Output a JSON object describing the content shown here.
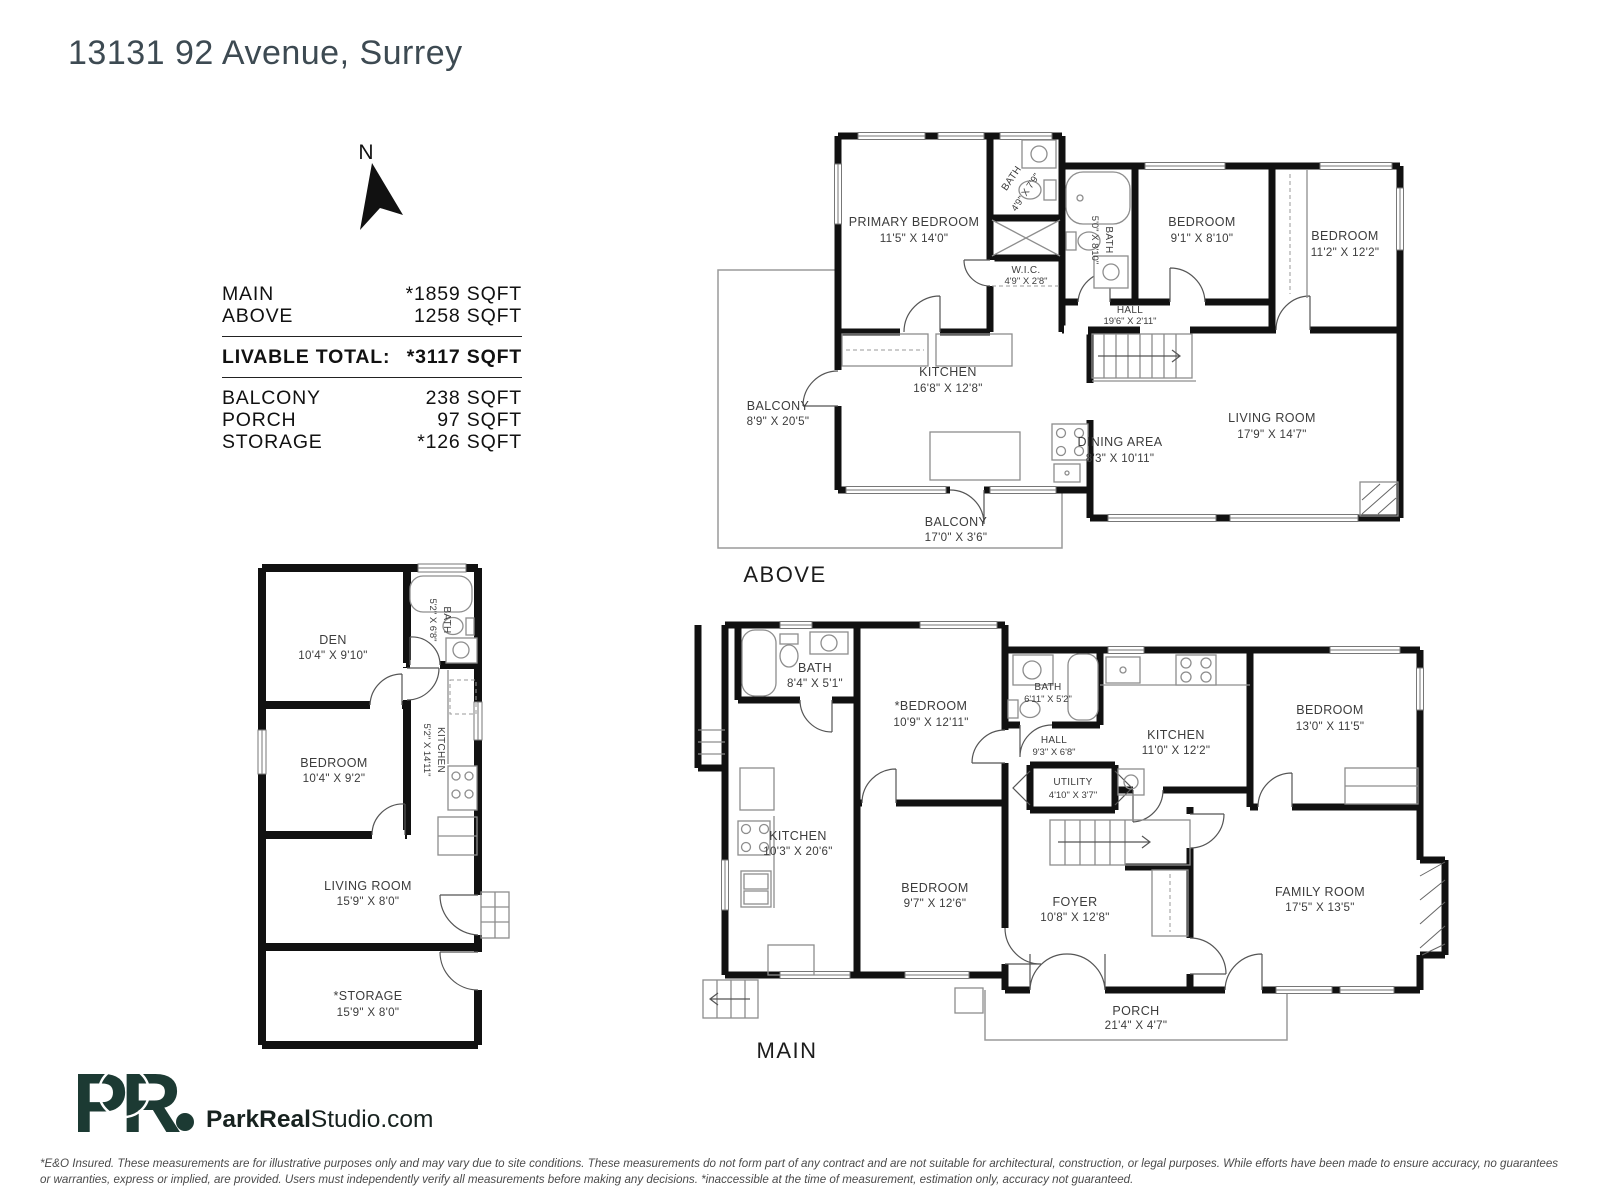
{
  "title": "13131 92 Avenue, Surrey",
  "compass": {
    "label": "N"
  },
  "area_summary": {
    "rows": [
      {
        "label": "MAIN",
        "value": "*1859 SQFT"
      },
      {
        "label": "ABOVE",
        "value": "1258 SQFT"
      }
    ],
    "total": {
      "label": "LIVABLE TOTAL:",
      "value": "*3117 SQFT"
    },
    "extras": [
      {
        "label": "BALCONY",
        "value": "238 SQFT"
      },
      {
        "label": "PORCH",
        "value": "97 SQFT"
      },
      {
        "label": "STORAGE",
        "value": "*126 SQFT"
      }
    ]
  },
  "plans": {
    "above": {
      "label": "ABOVE",
      "rooms": [
        {
          "name": "PRIMARY BEDROOM",
          "dims": "11'5\" X 14'0\""
        },
        {
          "name": "BATH",
          "dims": "4'9\" X 7'9\""
        },
        {
          "name": "W.I.C.",
          "dims": "4'9\" X 2'8\""
        },
        {
          "name": "BATH",
          "dims": "5'0\" X 8'10\""
        },
        {
          "name": "BEDROOM",
          "dims": "9'1\" X 8'10\""
        },
        {
          "name": "BEDROOM",
          "dims": "11'2\" X 12'2\""
        },
        {
          "name": "HALL",
          "dims": "19'6\" X 2'11\""
        },
        {
          "name": "KITCHEN",
          "dims": "16'8\" X 12'8\""
        },
        {
          "name": "DINING AREA",
          "dims": "8'3\" X 10'11\""
        },
        {
          "name": "LIVING ROOM",
          "dims": "17'9\" X 14'7\""
        },
        {
          "name": "BALCONY",
          "dims": "8'9\" X 20'5\""
        },
        {
          "name": "BALCONY",
          "dims": "17'0\" X 3'6\""
        }
      ]
    },
    "main": {
      "label": "MAIN",
      "rooms": [
        {
          "name": "BATH",
          "dims": "8'4\" X 5'1\""
        },
        {
          "name": "*BEDROOM",
          "dims": "10'9\" X 12'11\""
        },
        {
          "name": "BATH",
          "dims": "6'11\" X 5'2\""
        },
        {
          "name": "HALL",
          "dims": "9'3\" X 6'8\""
        },
        {
          "name": "KITCHEN",
          "dims": "11'0\" X 12'2\""
        },
        {
          "name": "BEDROOM",
          "dims": "13'0\" X 11'5\""
        },
        {
          "name": "UTILITY",
          "dims": "4'10\" X 3'7\""
        },
        {
          "name": "KITCHEN",
          "dims": "10'3\" X 20'6\""
        },
        {
          "name": "BEDROOM",
          "dims": "9'7\" X 12'6\""
        },
        {
          "name": "FOYER",
          "dims": "10'8\" X 12'8\""
        },
        {
          "name": "FAMILY ROOM",
          "dims": "17'5\" X 13'5\""
        },
        {
          "name": "PORCH",
          "dims": "21'4\" X 4'7\""
        }
      ]
    },
    "accessory": {
      "rooms": [
        {
          "name": "DEN",
          "dims": "10'4\" X 9'10\""
        },
        {
          "name": "BATH",
          "dims": "5'2\" X 6'8\""
        },
        {
          "name": "KITCHEN",
          "dims": "5'2\" X 14'11\""
        },
        {
          "name": "BEDROOM",
          "dims": "10'4\" X 9'2\""
        },
        {
          "name": "LIVING ROOM",
          "dims": "15'9\" X 8'0\""
        },
        {
          "name": "*STORAGE",
          "dims": "15'9\" X 8'0\""
        }
      ]
    }
  },
  "branding": {
    "logo_monogram": "PR",
    "website_bold": "ParkReal",
    "website_regular": "Studio.com",
    "logo_color": "#1c3a33"
  },
  "disclaimer": "*E&O Insured. These measurements are for illustrative purposes only and may vary due to site conditions. These measurements do not form part of any contract and are not suitable for architectural, construction, or legal purposes. While efforts have been made to ensure accuracy, no guarantees or warranties, express or implied, are provided. Users must independently verify all measurements before making any decisions. *inaccessible at the time of measurement, estimation only, accuracy not guaranteed."
}
